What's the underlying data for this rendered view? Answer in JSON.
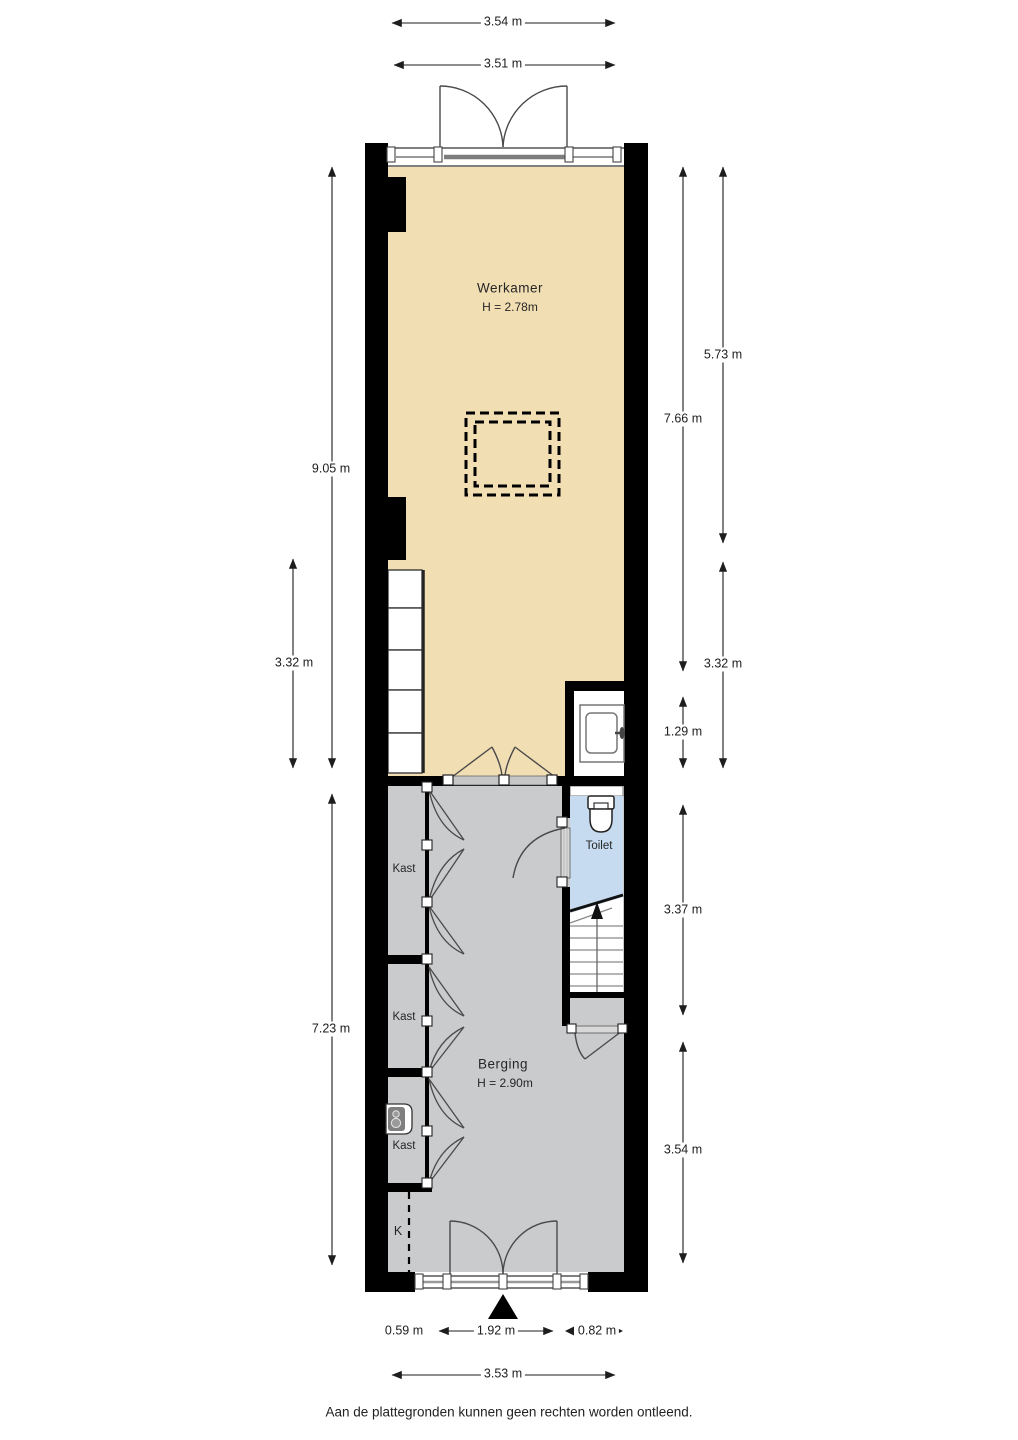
{
  "rooms": {
    "werkamer": {
      "name": "Werkamer",
      "height": "H = 2.78m"
    },
    "berging": {
      "name": "Berging",
      "height": "H = 2.90m"
    },
    "toilet": {
      "name": "Toilet"
    },
    "kast": {
      "name": "Kast"
    },
    "meterkast": {
      "name": "K"
    }
  },
  "dimensions": {
    "top_outer": "3.54 m",
    "top_inner": "3.51 m",
    "left_werkamer": "9.05 m",
    "left_closets": "3.32 m",
    "left_berging": "7.23 m",
    "right_upper": "5.73 m",
    "right_werkamer": "7.66 m",
    "right_closets": "3.32 m",
    "right_niche": "1.29 m",
    "right_stairs": "3.37 m",
    "right_berging": "3.54 m",
    "bottom_left": "0.59 m",
    "bottom_door": "1.92 m",
    "bottom_right": "0.82 m",
    "bottom_total": "3.53 m"
  },
  "colors": {
    "wall": "#000000",
    "werkamer_floor": "#F2DEB3",
    "berging_floor": "#CACBCC",
    "toilet_floor": "#C6DBEF",
    "stair_white": "#FFFFFF",
    "dimension_line": "#2a2a2a"
  },
  "footer": {
    "disclaimer": "Aan de plattegronden kunnen geen rechten worden ontleend."
  }
}
